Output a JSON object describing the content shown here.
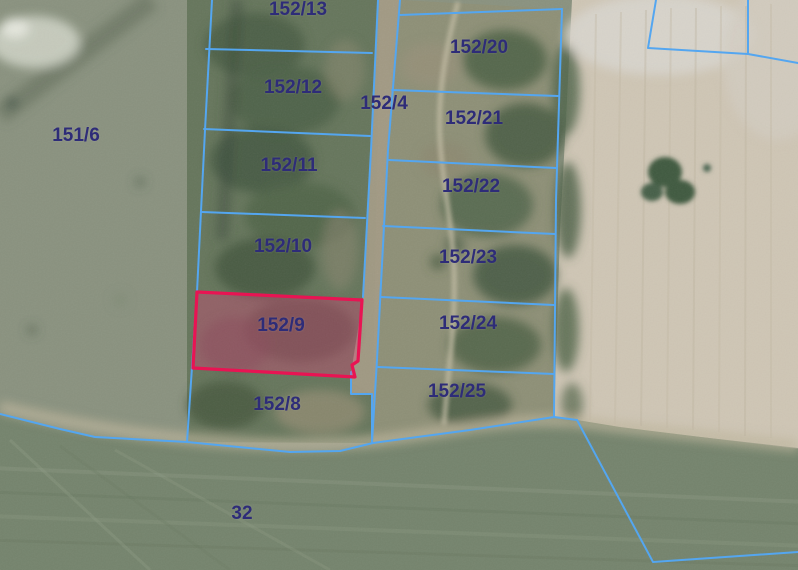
{
  "map": {
    "description": "Cadastral parcel boundaries overlaid on aerial orthophoto",
    "highlighted_parcel": "152/9",
    "colors": {
      "boundary-color": "#54a6f0",
      "highlight-color": "#e81453",
      "highlight-fill": "rgba(232,60,125,0.33)",
      "label-color": "#2e2c78"
    },
    "parcels": [
      {
        "label": "151/6"
      },
      {
        "label": "152/13"
      },
      {
        "label": "152/12"
      },
      {
        "label": "152/4"
      },
      {
        "label": "152/11"
      },
      {
        "label": "152/10"
      },
      {
        "label": "152/9",
        "highlighted": true
      },
      {
        "label": "152/8"
      },
      {
        "label": "152/20"
      },
      {
        "label": "152/21"
      },
      {
        "label": "152/22"
      },
      {
        "label": "152/23"
      },
      {
        "label": "152/24"
      },
      {
        "label": "152/25"
      },
      {
        "label": "32"
      }
    ]
  }
}
